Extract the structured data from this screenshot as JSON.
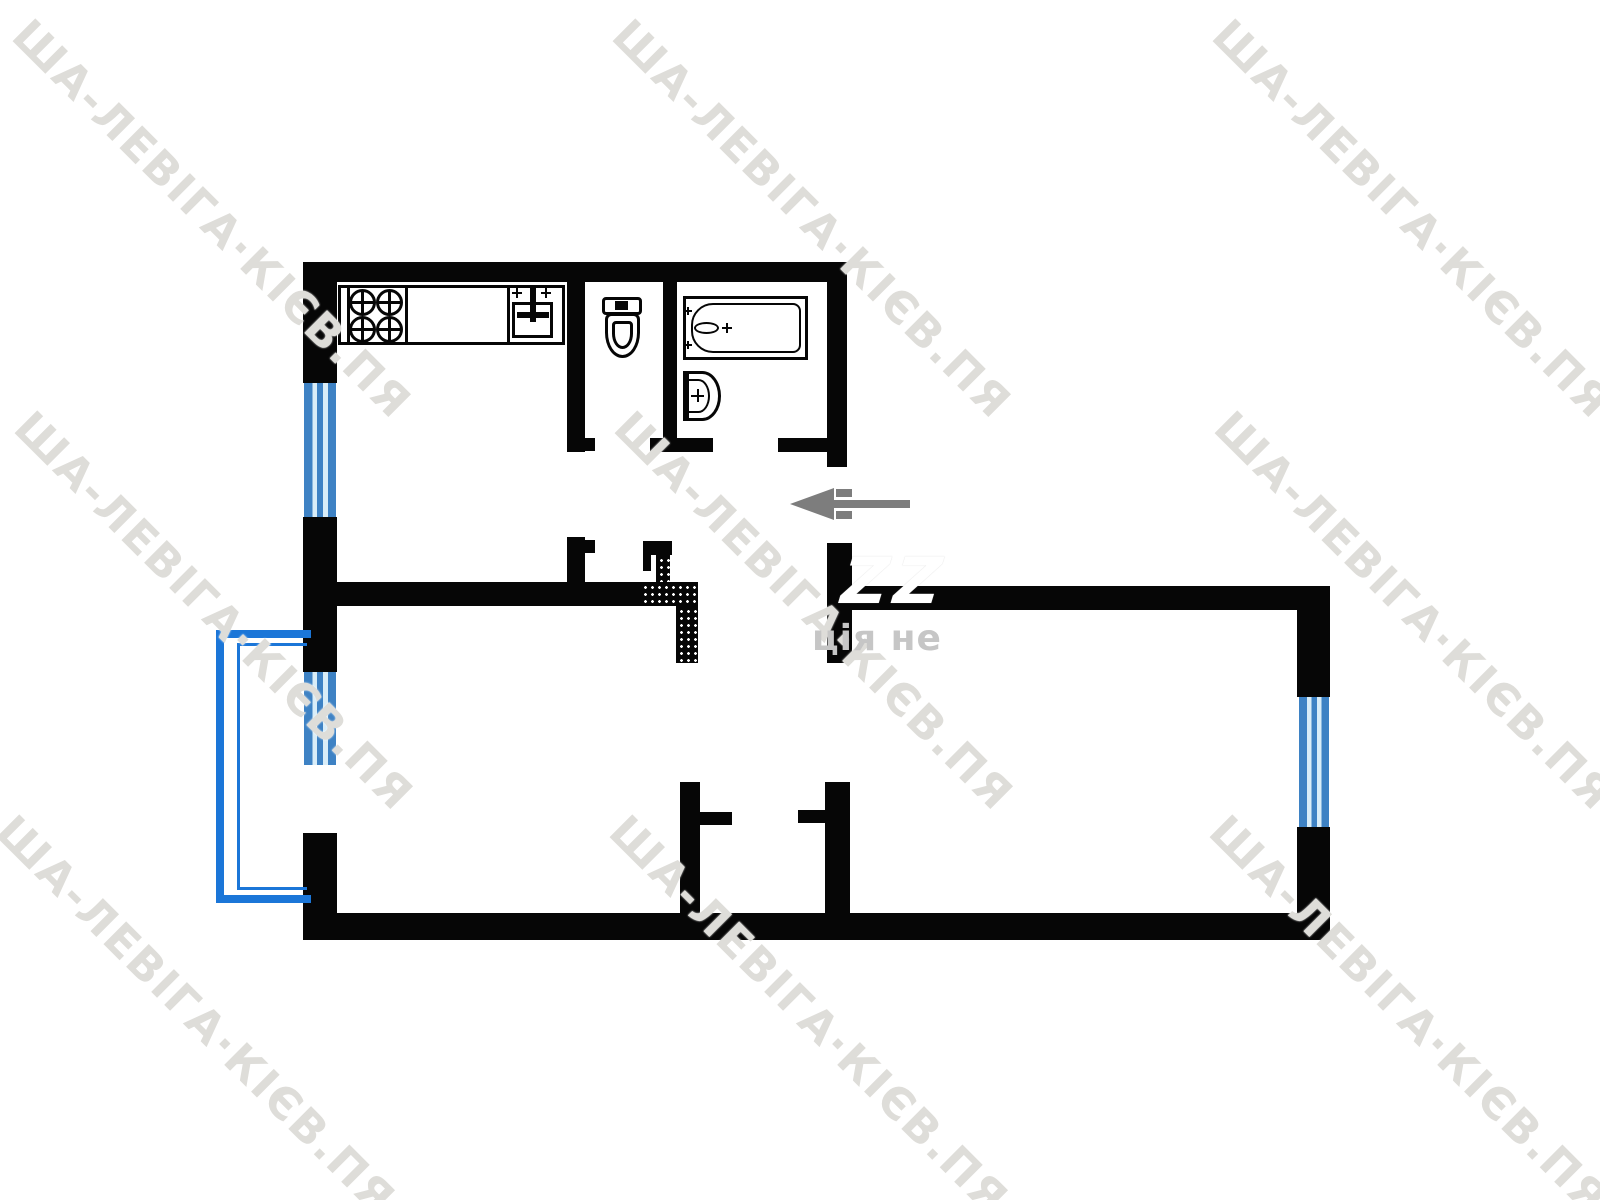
{
  "watermark": {
    "text": "ША-ЛЕВІГА·КІЄВ.ПЯ",
    "angle_deg": 45,
    "color": "#deddd9",
    "tile_count": 9
  },
  "center_overlay": {
    "white_fragment": "ZZ",
    "gray_fragment": "ція не"
  },
  "plan": {
    "type": "apartment-floor-plan",
    "colors": {
      "wall": "#060606",
      "window_frame": "#3e82c4",
      "window_glass": "#d9edf8",
      "balcony": "#1b76d8",
      "entrance_arrow": "#7d7d7d",
      "background": "#ffffff"
    },
    "entrance": {
      "marker": "arrow",
      "direction": "left",
      "side": "right-of-hall"
    },
    "balcony": {
      "side": "left",
      "attached_to": "living-room",
      "outline": "double-blue-line"
    },
    "windows": [
      {
        "location": "kitchen-left-wall"
      },
      {
        "location": "living-room-left-wall"
      },
      {
        "location": "bedroom-right-wall"
      }
    ],
    "rooms": [
      {
        "name": "kitchen",
        "fixtures": [
          "stove-4-burners",
          "countertop",
          "sink"
        ]
      },
      {
        "name": "wc",
        "fixtures": [
          "toilet"
        ]
      },
      {
        "name": "bathroom",
        "fixtures": [
          "bathtub",
          "washbasin"
        ]
      },
      {
        "name": "hall",
        "fixtures": [
          "vent-duct-hatched",
          "entrance-arrow"
        ]
      },
      {
        "name": "closet",
        "fixtures": []
      },
      {
        "name": "living-room",
        "fixtures": []
      },
      {
        "name": "bedroom",
        "fixtures": []
      }
    ]
  }
}
